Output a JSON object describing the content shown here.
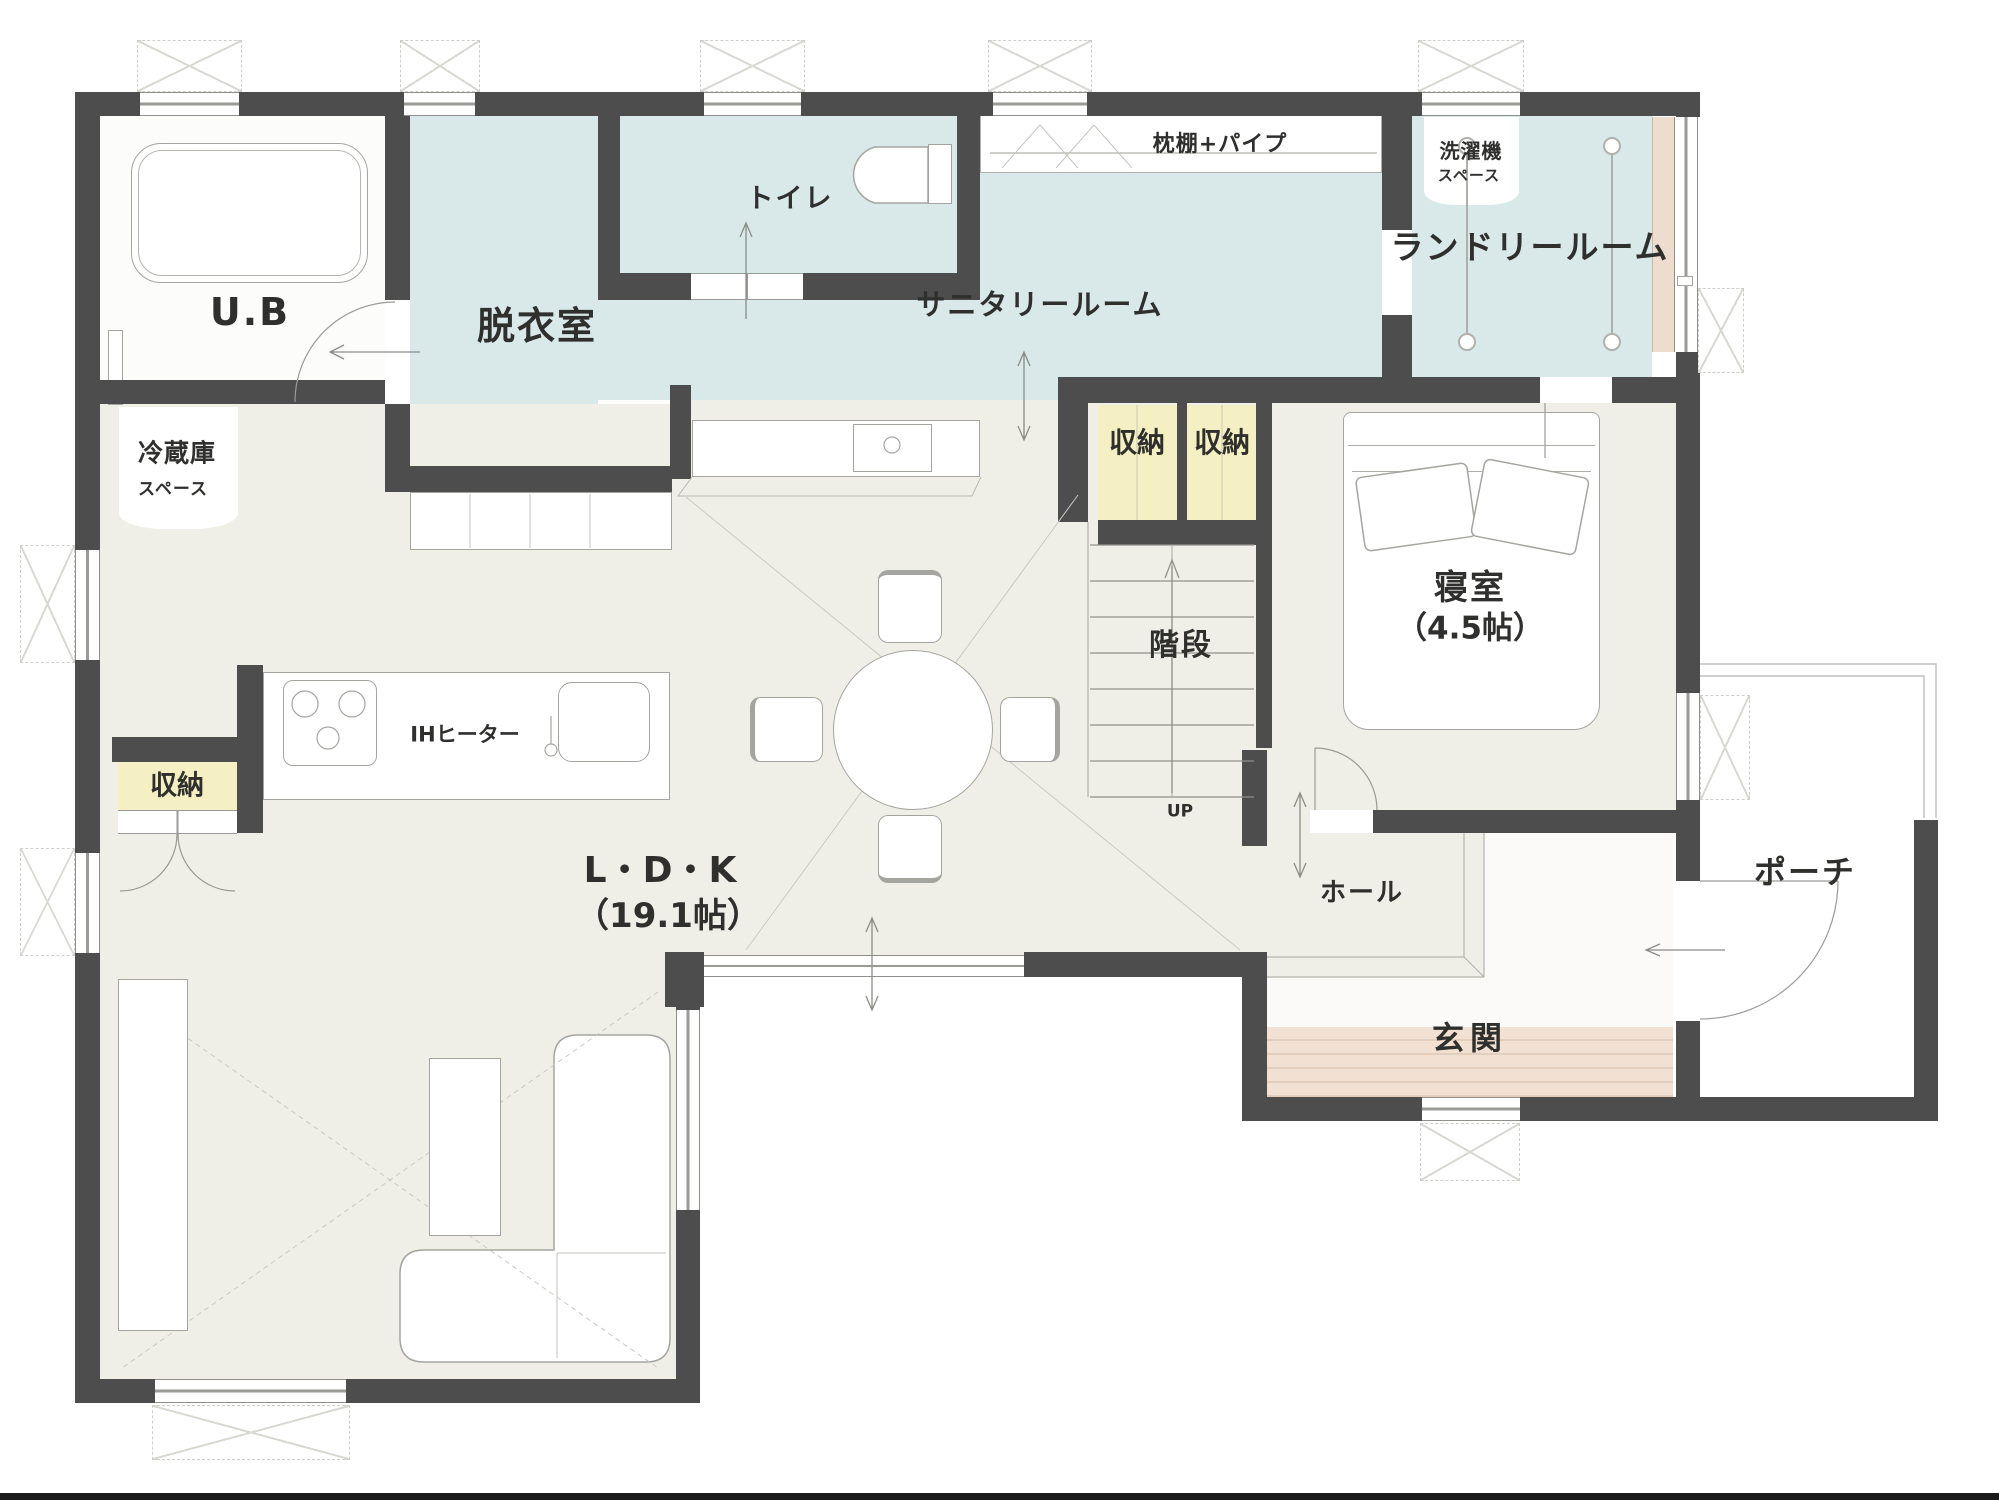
{
  "plan": {
    "rooms": {
      "ub": "U.B",
      "dressing": "脱衣室",
      "toilet": "トイレ",
      "sanitary": "サニタリールーム",
      "shelf_pipe": "枕棚+パイプ",
      "washer1": "洗濯機",
      "washer2": "スペース",
      "laundry": "ランドリールーム",
      "fridge1": "冷蔵庫",
      "fridge2": "スペース",
      "closet_a": "収納",
      "closet_b": "収納",
      "closet_kitchen": "収納",
      "bedroom": "寝室",
      "bedroom_size": "（4.5帖）",
      "stairs": "階段",
      "stairs_up": "UP",
      "ih_heater": "IHヒーター",
      "ldk": "L・D・K",
      "ldk_size": "（19.1帖）",
      "hall": "ホール",
      "entrance": "玄関",
      "porch": "ポーチ"
    },
    "colors": {
      "wall": "#4d4d4d",
      "wet_floor": "#d9e8e9",
      "main_floor": "#f0efe7",
      "closet_fill": "#f5f0c3",
      "entrance_tile": "#f2e1d3",
      "deck_strip": "#eedccf",
      "text": "#2f2f2d"
    }
  }
}
